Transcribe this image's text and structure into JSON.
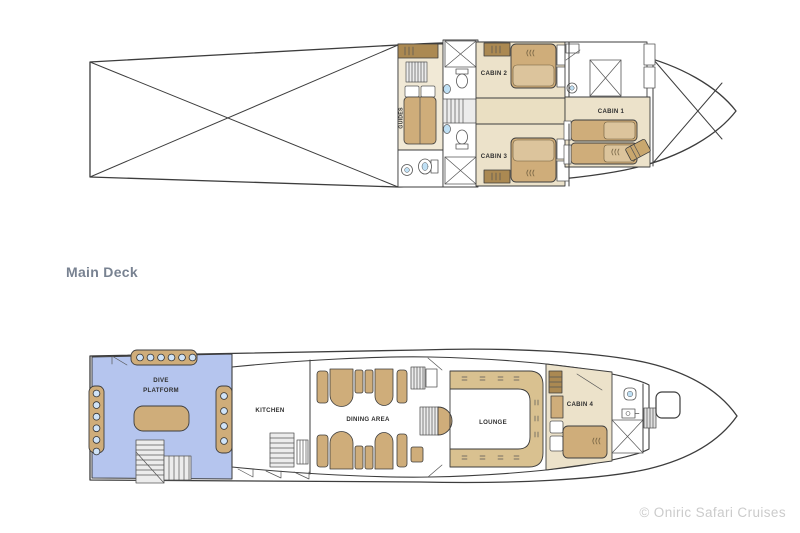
{
  "deck_labels": {
    "main": "Main Deck"
  },
  "upper_deck": {
    "guides": "GUIDES",
    "cabin1": "CABIN 1",
    "cabin2": "CABIN 2",
    "cabin3": "CABIN 3"
  },
  "main_deck": {
    "dive_platform_line1": "DIVE",
    "dive_platform_line2": "PLATFORM",
    "kitchen": "KITCHEN",
    "dining_area": "DINING AREA",
    "lounge": "LOUNGE",
    "cabin4": "CABIN 4"
  },
  "footer": {
    "copyright": "© Oniric Safari Cruises"
  },
  "colors": {
    "hull_line": "#3d3d3d",
    "cabin_floor": "#ece2ca",
    "corridor_floor": "#eadfc2",
    "furniture_tan": "#cfad7a",
    "furniture_light_tan": "#dcc49c",
    "furniture_dark_tan": "#ab8952",
    "sofa_tan": "#d9c190",
    "dive_platform_blue": "#b5c5ee",
    "tank_blue": "#cfe3f7",
    "fixture_blue": "#bfe0f5",
    "stairs_gray": "#ececec",
    "room_label": "#2f2f2f",
    "deck_label": "#788291",
    "copyright": "#cbcbcb"
  }
}
